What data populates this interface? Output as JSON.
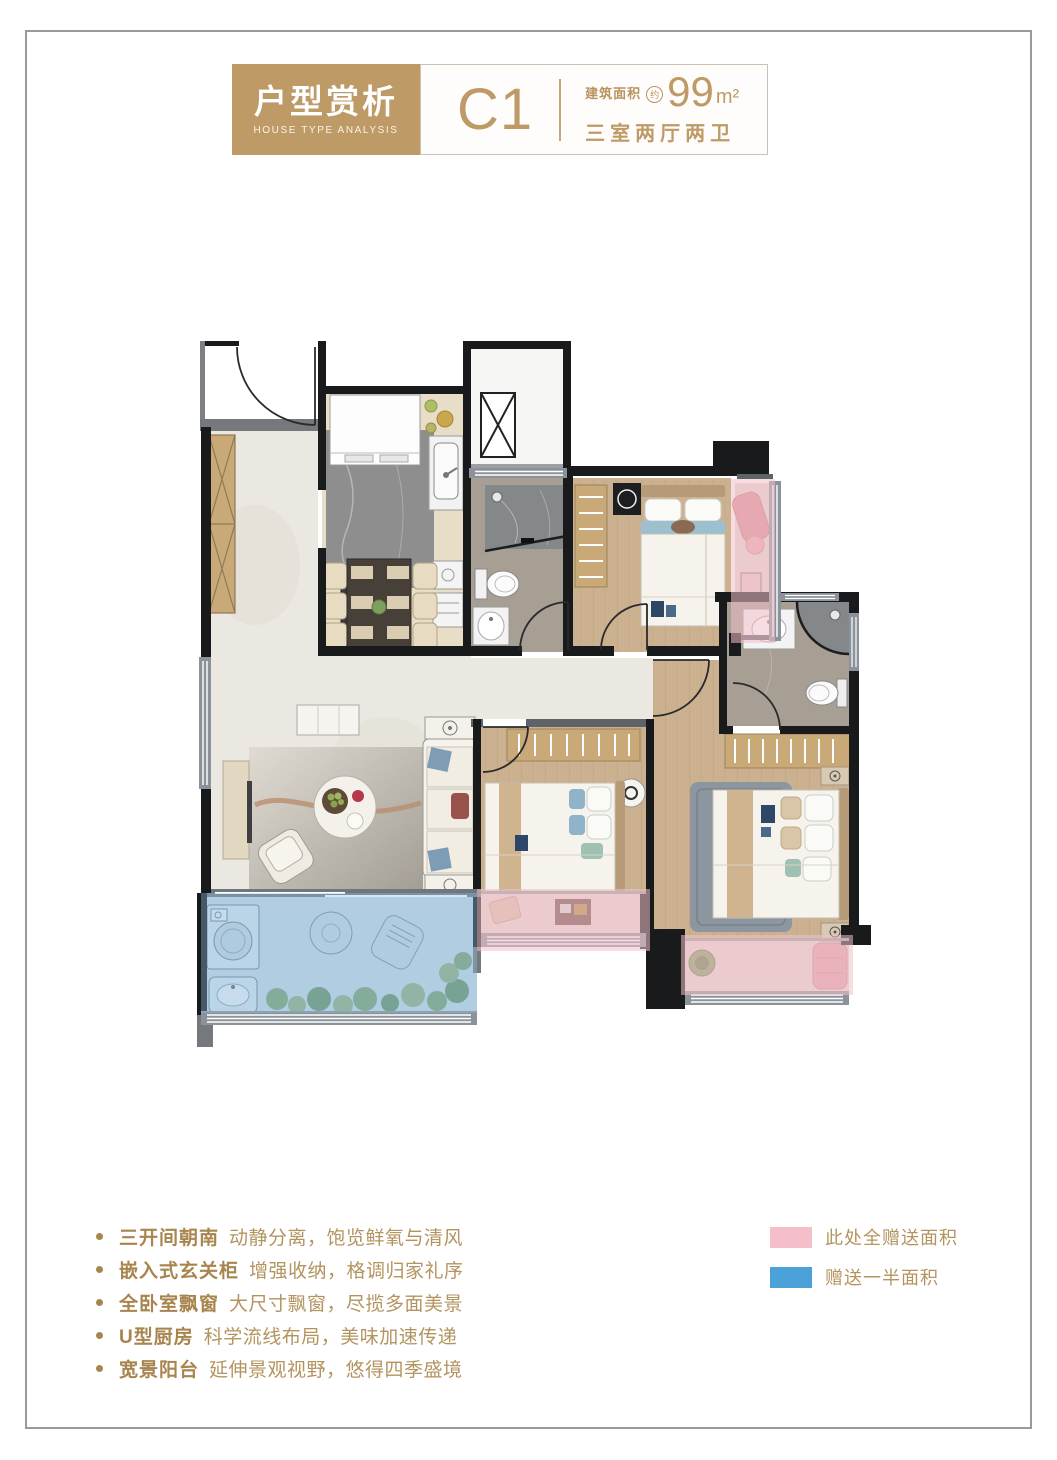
{
  "header": {
    "title_box": {
      "title": "户型赏析",
      "subtitle": "HOUSE TYPE ANALYSIS"
    },
    "unit": {
      "label": "C1"
    },
    "area": {
      "prefix": "建筑面积",
      "approx": "约",
      "value": "99",
      "unit": "m²"
    },
    "layout": "三室两厅两卫"
  },
  "features": {
    "items": [
      {
        "title": "三开间朝南",
        "desc": "动静分离，饱览鲜氧与清风"
      },
      {
        "title": "嵌入式玄关柜",
        "desc": "增强收纳，格调归家礼序"
      },
      {
        "title": "全卧室飘窗",
        "desc": "大尺寸飘窗，尽揽多面美景"
      },
      {
        "title": "U型厨房",
        "desc": "科学流线布局，美味加速传递"
      },
      {
        "title": "宽景阳台",
        "desc": "延伸景观视野，悠得四季盛境"
      }
    ]
  },
  "legend": {
    "items": [
      {
        "label": "此处全赠送面积",
        "color": "#f4bfca"
      },
      {
        "label": "赠送一半面积",
        "color": "#4aa2d9"
      }
    ]
  },
  "colors": {
    "accent_gold": "#bd9a66",
    "text_gold": "#b3945f",
    "wall_black": "#191a1c",
    "gift_full_pink": "#f0bfc9",
    "gift_half_blue": "#8fc0e4",
    "wood_floor": "#ccb191",
    "marble_floor": "#ebe8e1"
  }
}
